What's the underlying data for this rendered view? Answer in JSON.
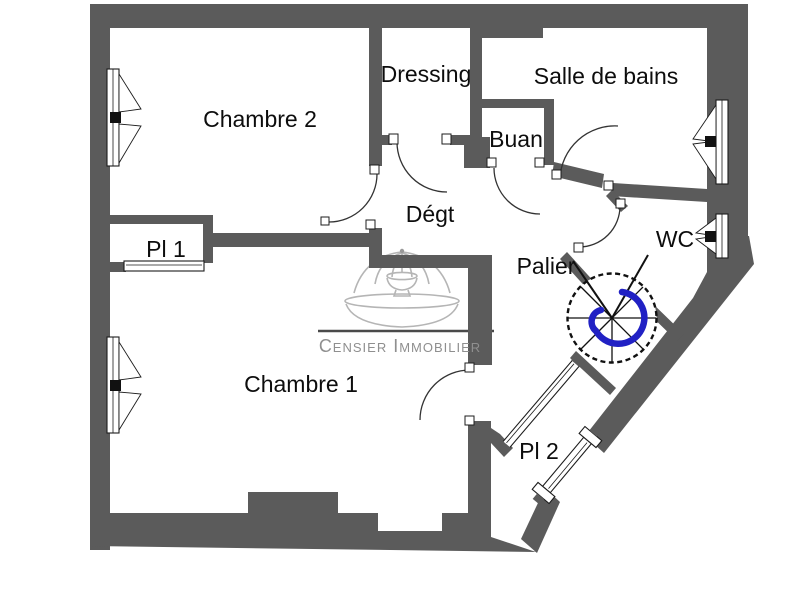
{
  "plan": {
    "title": "Floor plan",
    "watermark": {
      "text": "Censier Immobilier"
    },
    "rooms": [
      {
        "id": "chambre-2",
        "label": "Chambre 2"
      },
      {
        "id": "dressing",
        "label": "Dressing"
      },
      {
        "id": "salle-de-bains",
        "label": "Salle de bains"
      },
      {
        "id": "buanderie",
        "label": "Buan"
      },
      {
        "id": "degagement",
        "label": "Dégt"
      },
      {
        "id": "placard-1",
        "label": "Pl 1"
      },
      {
        "id": "palier",
        "label": "Palier"
      },
      {
        "id": "wc",
        "label": "WC"
      },
      {
        "id": "chambre-1",
        "label": "Chambre 1"
      },
      {
        "id": "placard-2",
        "label": "Pl 2"
      }
    ],
    "colors": {
      "wall": "#5b5b5b",
      "floor": "#ffffff",
      "stair_spiral_accent": "#2121c4",
      "watermark_gray": "#8f8f8f",
      "logo_gray": "#b5b5b5",
      "line": "#2a2a2a"
    },
    "features": [
      "spiral-staircase",
      "window-symbol",
      "door-arc",
      "sliding-door",
      "fountain-logo"
    ]
  }
}
